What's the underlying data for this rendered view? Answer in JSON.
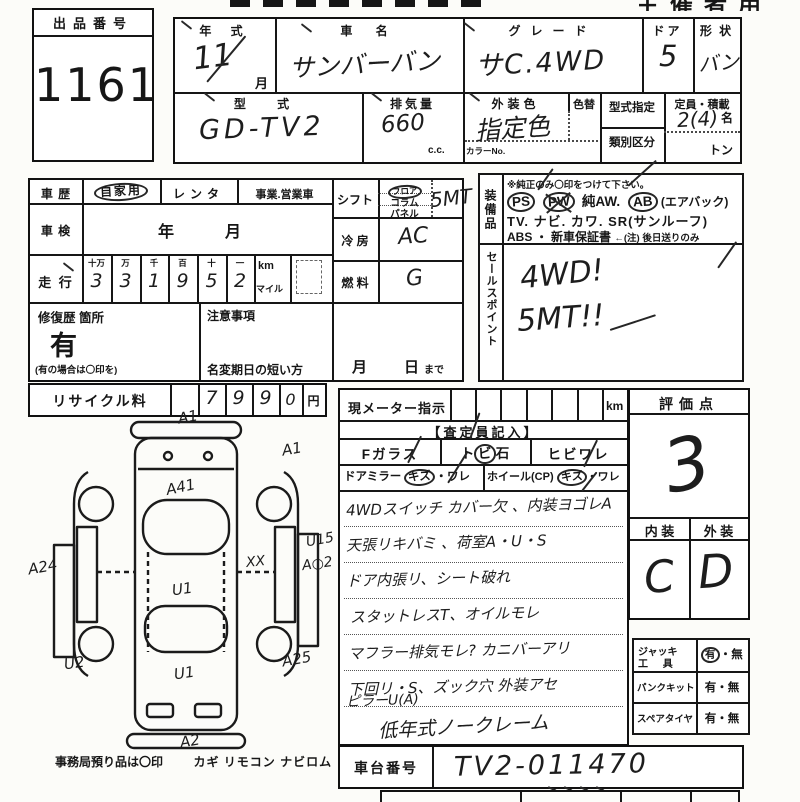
{
  "header": {
    "organizer": "主催者用"
  },
  "exhibit": {
    "label": "出品番号",
    "number": "1161"
  },
  "top": {
    "year_label": "年 式",
    "year_value": "11",
    "month_suffix": "月",
    "name_label": "車 名",
    "name_value": "サンバーバン",
    "grade_label": "グレード",
    "grade_value": "サC.4WD",
    "door_label": "ドア",
    "door_value": "5",
    "shape_label": "形 状",
    "shape_value": "バン",
    "model_label": "型 式",
    "model_value": "GD-TV2",
    "disp_label": "排気量",
    "disp_value": "660",
    "disp_unit": "c.c.",
    "color_label": "外装色",
    "color_value": "指定色",
    "repaint_label": "色替",
    "color_no_label": "カラーNo.",
    "type_desig_label": "型式指定",
    "class_label": "類別区分",
    "capacity_label": "定員・積載",
    "capacity_value": "2(4)",
    "capacity_unit": "名",
    "load_unit": "トン"
  },
  "history": {
    "label": "車 歴",
    "own": "自家用",
    "rental": "レンタ",
    "business": "事業.営業車"
  },
  "shaken": {
    "label": "車 検",
    "year": "年",
    "month": "月"
  },
  "mileage": {
    "label": "走 行",
    "h0": "十万",
    "h1": "万",
    "h2": "千",
    "h3": "百",
    "h4": "十",
    "h5": "一",
    "d0": "3",
    "d1": "3",
    "d2": "1",
    "d3": "9",
    "d4": "5",
    "d5": "2",
    "km": "km",
    "mile": "マイル"
  },
  "repair": {
    "label": "修復歴 箇所",
    "value": "有",
    "note": "(有の場合は〇印を)"
  },
  "caution": {
    "label": "注意事項",
    "line": "名変期日の短い方",
    "month": "月",
    "day": "日",
    "made": "まで"
  },
  "shift": {
    "label": "シフト",
    "o1": "フロア",
    "o2": "コラム",
    "o3": "パネル",
    "value": "5MT"
  },
  "aircon": {
    "label": "冷 房",
    "value": "AC"
  },
  "fuel": {
    "label": "燃 料",
    "value": "G"
  },
  "equipment": {
    "label": "装備品",
    "note": "※純正のみ〇印をつけて下さい。",
    "ps": "PS",
    "pw": "PW",
    "aw": "純AW.",
    "ab": "AB",
    "ab_note": "(エアバック)",
    "line2": "TV. ナビ. カワ. SR(サンルーフ)",
    "line3": "ABS ・ 新車保証書",
    "line3b": "←(注) 後日送りのみ"
  },
  "sales": {
    "label": "セールスポイント",
    "l1": "4WD!",
    "l2": "5MT!!"
  },
  "recycle": {
    "label": "リサイクル料",
    "d1": "7",
    "d2": "9",
    "d3": "9",
    "d4": "0",
    "unit": "円"
  },
  "meter": {
    "label": "現メーター指示",
    "unit": "km"
  },
  "assessor": {
    "header": "【査定員記入】",
    "fglass": "Fガラス",
    "tobi": "ト",
    "bi": "ビ",
    "ishi": "石",
    "hibiware": "ヒビワレ",
    "mirror": "ドアミラー",
    "kizu1": "キズ",
    "ware1": "ワレ",
    "wheel": "ホイール(CP)",
    "kizu2": "キズ",
    "ware2": "ワレ",
    "dot": "・",
    "notes": [
      "4WDスイッチ カバー欠 、内装ヨゴレA",
      "天張リキバミ 、荷室A・U・S",
      "ドア内張リ、シート破れ",
      "スタットレスT、オイルモレ",
      "マフラー排気モレ? カニバーアリ",
      "下回リ・S、ズック穴 外装アセ",
      "ピラーU(A)",
      "低年式ノークレーム"
    ]
  },
  "grade_point": {
    "label": "評価点",
    "value": "3",
    "interior_label": "内 装",
    "exterior_label": "外 装",
    "interior": "C",
    "exterior": "D"
  },
  "tools": {
    "jack1": "ジャッキ",
    "jack2": "工 具",
    "puncture": "パンクキット",
    "spare": "スペアタイヤ",
    "yes": "有",
    "no": "無",
    "dot": "・"
  },
  "chassis": {
    "label": "車台番号",
    "value": "TV2-011470"
  },
  "office": {
    "note": "事務局預り品は〇印",
    "items": "カギ リモコン ナビロム"
  },
  "diagram": {
    "codes": [
      "A1",
      "A1",
      "A41",
      "A24",
      "U1",
      "XX",
      "U15",
      "A○2",
      "U2",
      "U1",
      "A25",
      "A2"
    ]
  }
}
